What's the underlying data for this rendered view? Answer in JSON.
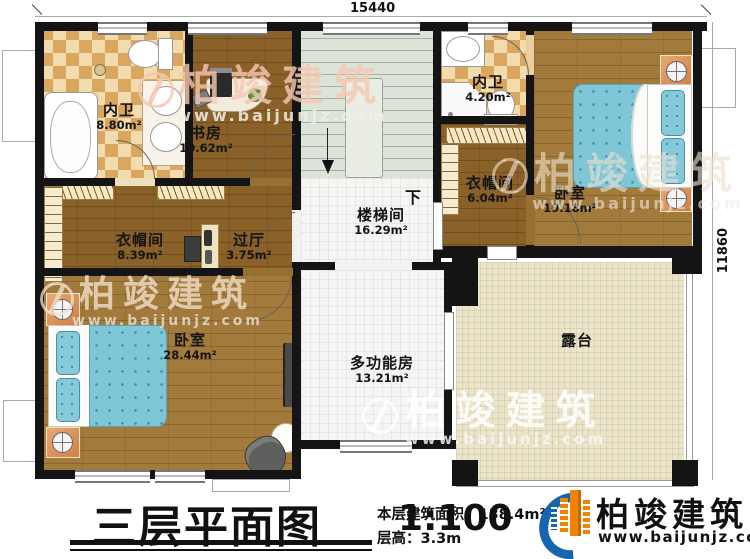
{
  "annotations": {
    "dim_top": "15440",
    "dim_right": "11860"
  },
  "rooms": {
    "bath1": {
      "name": "内卫",
      "area": "8.80m²"
    },
    "study": {
      "name": "书房",
      "area": "10.62m²"
    },
    "stairwell": {
      "name": "楼梯间",
      "area": "16.29m²"
    },
    "bath2": {
      "name": "内卫",
      "area": "4.20m²"
    },
    "closet2": {
      "name": "衣帽间",
      "area": "6.04m²"
    },
    "bedroom2": {
      "name": "卧室",
      "area": "19.18m²"
    },
    "closet1": {
      "name": "衣帽间",
      "area": "8.39m²"
    },
    "hall": {
      "name": "过厅",
      "area": "3.75m²"
    },
    "bedroom1": {
      "name": "卧室",
      "area": "28.44m²"
    },
    "multi": {
      "name": "多功能房",
      "area": "13.21m²"
    },
    "terrace": {
      "name": "露台"
    }
  },
  "stairs": {
    "down": "下"
  },
  "footer": {
    "title": "三层平面图",
    "scale": "1:100",
    "area_label": "本层建筑面积：",
    "area_value": "138.4m²",
    "height_label": "层高：",
    "height_value": "3.3m"
  },
  "brand": {
    "name": "柏竣建筑",
    "site": "www.baijunjz.com"
  },
  "watermark": {
    "name": "柏竣建筑",
    "site": "www.baijunjz.com"
  },
  "colors": {
    "wall": "#141414",
    "wood": "#a27a3b",
    "wood_dark": "#8a6128",
    "tile_light": "#f2dcae",
    "tile_dark": "#d9a75f",
    "stair": "#dce3d7",
    "terrace": "#ece5c9",
    "bed_teal": "#7fc6d6",
    "nightstand_orange": "#d07f47",
    "logo_blue": "#1565b0",
    "logo_orange": "#f08300"
  }
}
